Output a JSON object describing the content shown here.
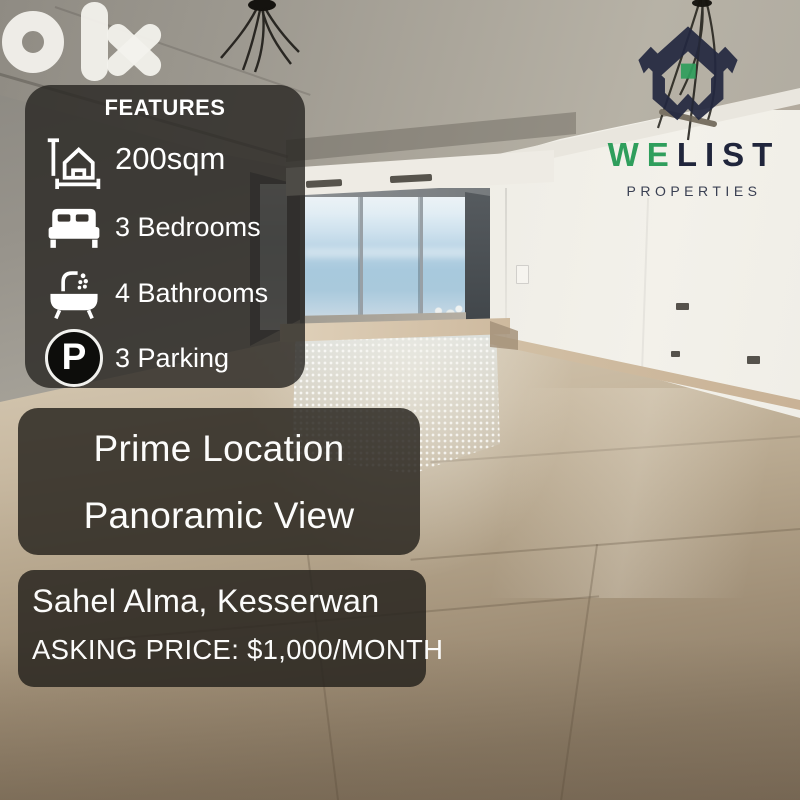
{
  "brand": {
    "watermark": "olx"
  },
  "features": {
    "heading": "FEATURES",
    "parking_letter": "P",
    "items": [
      {
        "icon": "area-icon",
        "label": "200sqm"
      },
      {
        "icon": "bed-icon",
        "label": "3 Bedrooms"
      },
      {
        "icon": "bath-icon",
        "label": "4 Bathrooms"
      },
      {
        "icon": "parking-icon",
        "label": "3 Parking"
      }
    ]
  },
  "agency": {
    "name_we": "WE",
    "name_list": "LIST",
    "subtitle": "PROPERTIES",
    "brand_green": "#2f9e5c",
    "brand_navy": "#232840"
  },
  "highlights": {
    "line1": "Prime Location",
    "line2": "Panoramic View"
  },
  "listing": {
    "location": "Sahel Alma, Kesserwan",
    "price_label": "ASKING PRICE: $1,000/MONTH"
  },
  "colors": {
    "overlay_panel": "#2a2723",
    "text": "#ffffff",
    "sea": "#a7c8dc",
    "floor_tone": "#a8977f"
  }
}
